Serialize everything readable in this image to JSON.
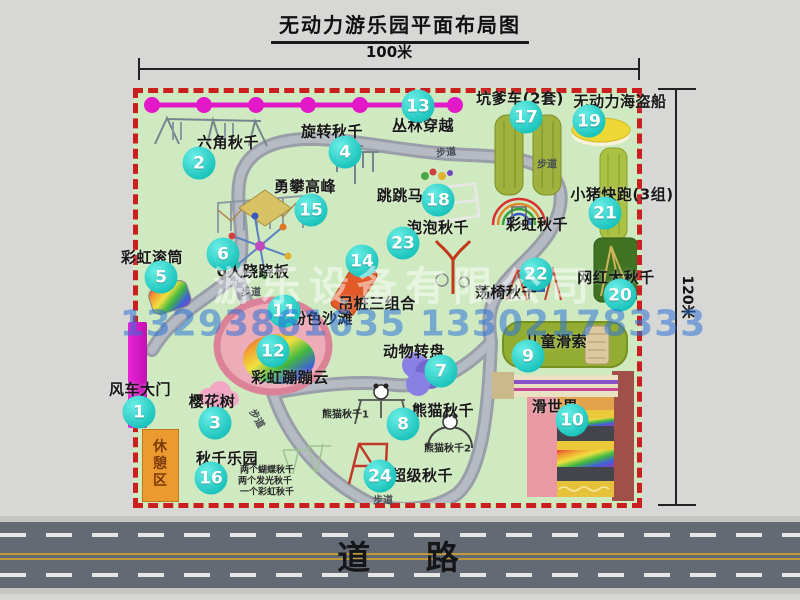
{
  "title": "无动力游乐园平面布局图",
  "dimensions": {
    "width_label": "100米",
    "height_label": "120米"
  },
  "road": {
    "label": "道 路"
  },
  "watermark": {
    "company": "游乐设备有限公司",
    "phone": "13293861635 13302178333"
  },
  "colors": {
    "park_green": "#cfeac0",
    "border_red": "#cb1e1e",
    "badge_teal": "#19c3bb",
    "chain_magenta": "#e318c8",
    "gate_magenta": "#d916c6",
    "rest_area_orange": "#ea9a2e",
    "road_asphalt": "#646a74",
    "watermark_blue": "#2d73d7"
  },
  "park": {
    "attractions": [
      {
        "num": "1",
        "name": "风车大门",
        "badge": {
          "x": 139,
          "y": 412
        },
        "label": {
          "x": 140,
          "y": 389
        }
      },
      {
        "num": "2",
        "name": "六角秋千",
        "badge": {
          "x": 199,
          "y": 163
        },
        "label": {
          "x": 228,
          "y": 142
        }
      },
      {
        "num": "3",
        "name": "樱花树",
        "badge": {
          "x": 215,
          "y": 423
        },
        "label": {
          "x": 212,
          "y": 401
        }
      },
      {
        "num": "4",
        "name": "旋转秋千",
        "badge": {
          "x": 345,
          "y": 152
        },
        "label": {
          "x": 332,
          "y": 131
        }
      },
      {
        "num": "5",
        "name": "彩虹滚筒",
        "badge": {
          "x": 161,
          "y": 277
        },
        "label": {
          "x": 152,
          "y": 257
        }
      },
      {
        "num": "6",
        "name": "6人跷跷板",
        "badge": {
          "x": 223,
          "y": 254
        },
        "label": {
          "x": 253,
          "y": 271
        }
      },
      {
        "num": "7",
        "name": "动物转盘",
        "badge": {
          "x": 441,
          "y": 371
        },
        "label": {
          "x": 414,
          "y": 351
        }
      },
      {
        "num": "8",
        "name": "熊猫秋千",
        "badge": {
          "x": 403,
          "y": 424
        },
        "label": {
          "x": 443,
          "y": 410
        }
      },
      {
        "num": "9",
        "name": "儿童滑索",
        "badge": {
          "x": 528,
          "y": 356
        },
        "label": {
          "x": 556,
          "y": 341
        }
      },
      {
        "num": "10",
        "name": "滑世界",
        "badge": {
          "x": 572,
          "y": 420
        },
        "label": {
          "x": 555,
          "y": 406
        }
      },
      {
        "num": "11",
        "name": "粉色沙滩",
        "badge": {
          "x": 284,
          "y": 311
        },
        "label": {
          "x": 322,
          "y": 318
        }
      },
      {
        "num": "12",
        "name": "彩虹蹦蹦云",
        "badge": {
          "x": 273,
          "y": 351
        },
        "label": {
          "x": 290,
          "y": 377
        }
      },
      {
        "num": "13",
        "name": "丛林穿越",
        "badge": {
          "x": 418,
          "y": 106
        },
        "label": {
          "x": 423,
          "y": 125
        }
      },
      {
        "num": "14",
        "name": "吊桩三组合",
        "badge": {
          "x": 362,
          "y": 261
        },
        "label": {
          "x": 377,
          "y": 303
        }
      },
      {
        "num": "15",
        "name": "勇攀高峰",
        "badge": {
          "x": 311,
          "y": 210
        },
        "label": {
          "x": 305,
          "y": 186
        }
      },
      {
        "num": "16",
        "name": "秋千乐园",
        "badge": {
          "x": 211,
          "y": 478
        },
        "label": {
          "x": 227,
          "y": 458
        }
      },
      {
        "num": "17",
        "name": "坑爹车(2套)",
        "badge": {
          "x": 526,
          "y": 117
        },
        "label": {
          "x": 520,
          "y": 98
        }
      },
      {
        "num": "18",
        "name": "跳跳马",
        "badge": {
          "x": 438,
          "y": 200
        },
        "label": {
          "x": 400,
          "y": 195
        }
      },
      {
        "num": "19",
        "name": "无动力海盗船",
        "badge": {
          "x": 589,
          "y": 121
        },
        "label": {
          "x": 620,
          "y": 101
        }
      },
      {
        "num": "20",
        "name": "网红大秋千",
        "badge": {
          "x": 620,
          "y": 295
        },
        "label": {
          "x": 616,
          "y": 277
        }
      },
      {
        "num": "21",
        "name": "小猪快跑(3组)",
        "badge": {
          "x": 605,
          "y": 213
        },
        "label": {
          "x": 622,
          "y": 194
        }
      },
      {
        "num": "22",
        "name": "荡椅秋千",
        "badge": {
          "x": 536,
          "y": 274
        },
        "label": {
          "x": 506,
          "y": 292
        }
      },
      {
        "num": "23",
        "name": "泡泡秋千",
        "badge": {
          "x": 403,
          "y": 243
        },
        "label": {
          "x": 438,
          "y": 227
        }
      },
      {
        "num": "24",
        "name": "超级秋千",
        "badge": {
          "x": 380,
          "y": 476
        },
        "label": {
          "x": 422,
          "y": 475
        }
      },
      {
        "num": null,
        "name": "彩虹秋千",
        "label": {
          "x": 537,
          "y": 224
        }
      },
      {
        "num": null,
        "name": "休憩区",
        "label": {
          "x": 159,
          "y": 464,
          "size": 14
        },
        "vertical": true
      }
    ],
    "sub_labels": [
      {
        "text": "熊猫秋千1",
        "x": 322,
        "y": 413,
        "size": 10
      },
      {
        "text": "熊猫秋千2",
        "x": 424,
        "y": 447,
        "size": 10
      },
      {
        "text": "两个蝴蝶秋千",
        "x": 240,
        "y": 469,
        "size": 9
      },
      {
        "text": "两个发光秋千",
        "x": 238,
        "y": 480,
        "size": 9
      },
      {
        "text": "一个彩虹秋千",
        "x": 240,
        "y": 491,
        "size": 9
      }
    ],
    "path_labels": [
      {
        "text": "步道",
        "x": 446,
        "y": 151,
        "rot": -6
      },
      {
        "text": "步道",
        "x": 547,
        "y": 163,
        "rot": 0
      },
      {
        "text": "步道",
        "x": 251,
        "y": 291,
        "rot": 0
      },
      {
        "text": "步道",
        "x": 383,
        "y": 499,
        "rot": 0
      },
      {
        "text": "步道",
        "x": 258,
        "y": 418,
        "rot": 60
      }
    ]
  }
}
